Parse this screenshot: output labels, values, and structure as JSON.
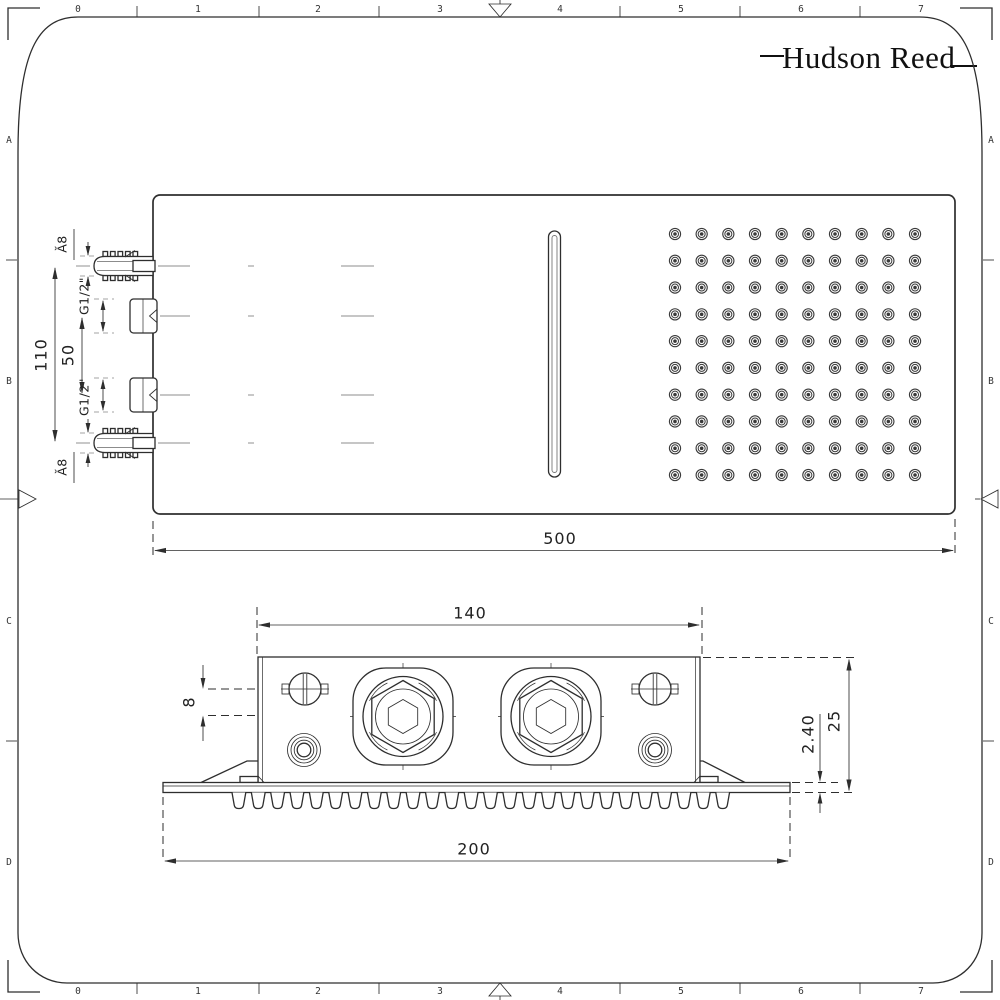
{
  "brand": {
    "name": "Hudson Reed"
  },
  "frame": {
    "columns": [
      "0",
      "1",
      "2",
      "3",
      "4",
      "5",
      "6",
      "7"
    ],
    "rows": [
      "A",
      "B",
      "C",
      "D"
    ]
  },
  "top_view": {
    "overall_width": "500",
    "mount_spacing": "110",
    "inlet_spacing": "50",
    "inlet_thread_top": "G1/2\"",
    "inlet_thread_bottom": "G1/2\"",
    "anchor_dia_top": "Ă8",
    "anchor_dia_bottom": "Ă8",
    "nozzles": {
      "rows": 10,
      "cols": 10
    }
  },
  "side_view": {
    "body_width": "140",
    "axis_offset": "8",
    "face_thickness": "2.40",
    "body_depth": "25",
    "face_width": "200"
  }
}
